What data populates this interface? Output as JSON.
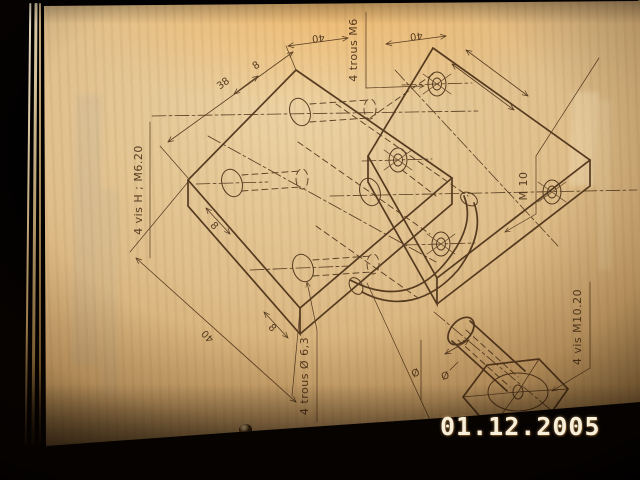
{
  "photo": {
    "date_stamp": "01.12.2005",
    "date_color": "#f8efda",
    "paper_color": "#dfbe8a",
    "line_color": "#4a3018"
  },
  "drawing": {
    "labels": {
      "dim_38": "38",
      "dim_8_top": "8",
      "dim_40_top_left": "40",
      "dim_40_top_right": "40",
      "holes_top_note": "4 trous M6",
      "screws_left_note": "4 vis H ; M6.20",
      "dim_8_left": "8",
      "dim_8_bottom": "8",
      "dim_40_bottom": "40",
      "holes_bottom_note": "4 trous Ø 6,3",
      "thread_note": "M 10",
      "screws_right_note": "4 vis M10.20",
      "dia_symbol_left": "Ø",
      "dia_symbol_right": "Ø"
    }
  }
}
